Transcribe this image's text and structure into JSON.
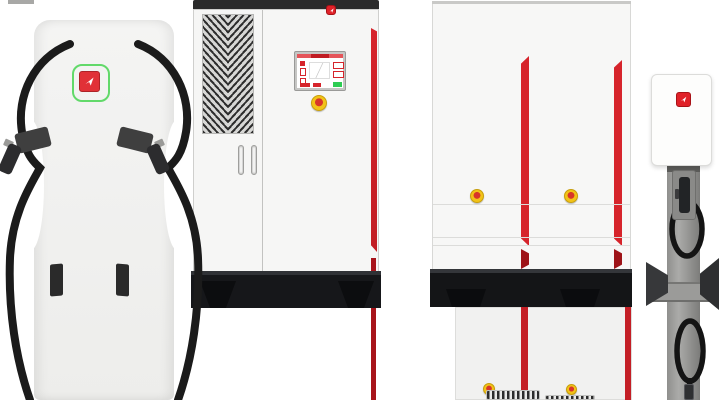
{
  "brand": {
    "name": "HOUJING",
    "vertical_name": "厚景HOUJING",
    "logo_icon": "red-square-arrow",
    "colors": {
      "brand_red": "#d6242b",
      "logo_green": "#56d75f",
      "indicator_orange": "#ea6a2f",
      "led_green": "#3fc24d",
      "estop_yellow": "#f2c318",
      "estop_red": "#d8362a"
    }
  },
  "cabinet": {
    "logo_text": "HOUJING"
  },
  "rack": {
    "side_label": "厚景HOUJING",
    "columns": 2,
    "modules_per_column": 8,
    "switch_label": "DC",
    "switches_per_column": 2,
    "estops": 2
  },
  "charger_pile": {
    "indicator_arcs": 3,
    "guns": 2
  },
  "module_shelf_left": {
    "orange_connectors": 5,
    "black_connectors": 1,
    "led_groups": 4,
    "modules": 2
  },
  "module_shelf_right": {
    "square_connectors": [
      "orange",
      "black",
      "orange",
      "black"
    ],
    "round_connectors": 4,
    "led_groups": 4,
    "modules": 2
  },
  "inverter_large": {
    "led_count": 4
  },
  "inverter_small": {
    "led_count": 4
  },
  "wallbox": {
    "led_count": 4
  }
}
